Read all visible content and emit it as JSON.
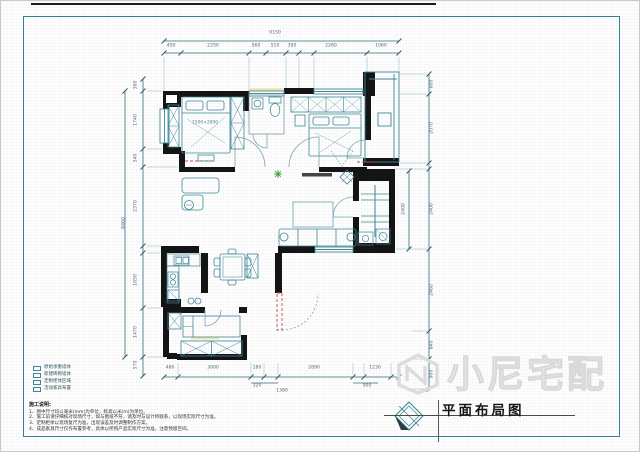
{
  "frame": {
    "title": "平面布局图"
  },
  "watermark": {
    "brand": "小尼宅配"
  },
  "plan_labels": [
    {
      "t": "1500×2000",
      "x": 204,
      "y": 122
    }
  ],
  "dim_labels": {
    "top": [
      {
        "t": "9150",
        "x": 274,
        "y": 33
      },
      {
        "t": "450",
        "x": 170,
        "y": 46
      },
      {
        "t": "2250",
        "x": 212,
        "y": 46
      },
      {
        "t": "560",
        "x": 255,
        "y": 46
      },
      {
        "t": "510",
        "x": 274,
        "y": 46
      },
      {
        "t": "390",
        "x": 291,
        "y": 46
      },
      {
        "t": "2260",
        "x": 330,
        "y": 46
      },
      {
        "t": "1060",
        "x": 380,
        "y": 46
      }
    ],
    "bottom": [
      {
        "t": "480",
        "x": 169,
        "y": 368
      },
      {
        "t": "3000",
        "x": 212,
        "y": 368
      },
      {
        "t": "180",
        "x": 256,
        "y": 368
      },
      {
        "t": "2890",
        "x": 313,
        "y": 368
      },
      {
        "t": "1230",
        "x": 374,
        "y": 368
      },
      {
        "t": "320",
        "x": 256,
        "y": 386
      },
      {
        "t": "1380",
        "x": 281,
        "y": 391
      },
      {
        "t": "900",
        "x": 366,
        "y": 386
      }
    ],
    "left": [
      {
        "t": "360",
        "x": 136,
        "y": 84,
        "r": 1
      },
      {
        "t": "1740",
        "x": 136,
        "y": 119,
        "r": 1
      },
      {
        "t": "540",
        "x": 136,
        "y": 157,
        "r": 1
      },
      {
        "t": "2370",
        "x": 136,
        "y": 205,
        "r": 1
      },
      {
        "t": "1650",
        "x": 136,
        "y": 279,
        "r": 1
      },
      {
        "t": "1470",
        "x": 136,
        "y": 331,
        "r": 1
      },
      {
        "t": "570",
        "x": 136,
        "y": 364,
        "r": 1
      },
      {
        "t": "8460",
        "x": 124,
        "y": 222,
        "r": 1
      }
    ],
    "right": [
      {
        "t": "600",
        "x": 432,
        "y": 83,
        "r": 1
      },
      {
        "t": "2070",
        "x": 432,
        "y": 127,
        "r": 1
      },
      {
        "t": "2400",
        "x": 432,
        "y": 208,
        "r": 1
      },
      {
        "t": "2460",
        "x": 432,
        "y": 289,
        "r": 1
      },
      {
        "t": "840",
        "x": 432,
        "y": 344,
        "r": 1
      },
      {
        "t": "900",
        "x": 432,
        "y": 373,
        "r": 1
      },
      {
        "t": "2400",
        "x": 404,
        "y": 208,
        "r": 1
      }
    ]
  },
  "legend": {
    "items": [
      {
        "label": "原始承重墙体"
      },
      {
        "label": "新建砖砌墙体"
      },
      {
        "label": "定制柜体区域"
      },
      {
        "label": "活动家具布置"
      }
    ]
  },
  "notes": {
    "heading": "施工说明:",
    "lines": [
      "1、图中尺寸均以毫米(mm)为单位，标高以米(m)为单位。",
      "2、施工前请仔细核对现场尺寸，如与图纸不符，请及时与设计师联系，以现场实际尺寸为准。",
      "3、定制柜体以现场复尺为准，出现误差及时调整制作方案。",
      "4、成品家具尺寸仅作布置参考，具体以所购产品实际尺寸为准，注意预留空间。"
    ]
  }
}
